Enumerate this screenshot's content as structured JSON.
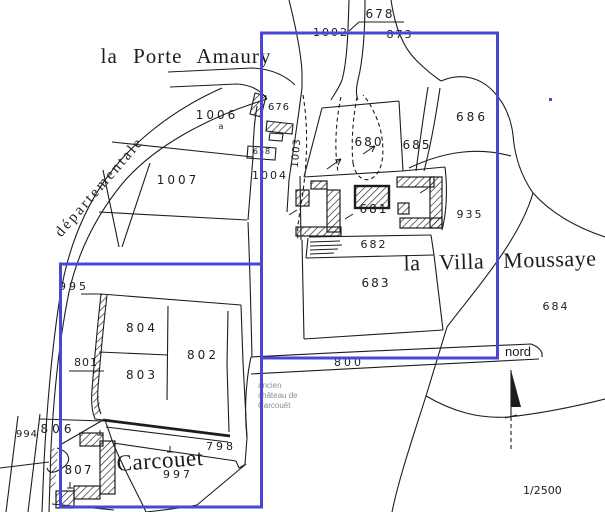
{
  "map": {
    "background": "#ffffff",
    "ink_color": "#1d1d1d",
    "highlight_color": "#4a46d6",
    "note_color": "#8d8d8d",
    "scale_label": "1/2500",
    "north_label": "nord",
    "annotation": {
      "l1": "ancien",
      "l2": "château de",
      "l3": "Carcouët"
    },
    "place_labels": [
      {
        "id": "porte-amaury",
        "text": "la Porte Amaury",
        "x": 186,
        "y": 46,
        "size": 21,
        "rot": 0,
        "ws": 9,
        "ls": 1
      },
      {
        "id": "villa-moussaye",
        "text": "la Villa Moussaye",
        "x": 500,
        "y": 250,
        "size": 22,
        "rot": -1.5,
        "ws": 13,
        "ls": 0.5
      },
      {
        "id": "carcouet",
        "text": "Carcouet",
        "x": 160,
        "y": 449,
        "size": 23,
        "rot": -4,
        "ws": 0,
        "ls": 0.5
      },
      {
        "id": "departementale",
        "text": "départementale",
        "x": 100,
        "y": 180,
        "size": 15,
        "rot": -49,
        "ws": 0,
        "ls": 2.5
      }
    ],
    "parcel_labels": [
      {
        "id": "678",
        "text": "678",
        "x": 380,
        "y": 8,
        "size": 12,
        "ls": 2,
        "rot": 0
      },
      {
        "id": "1002",
        "text": "1002",
        "x": 331,
        "y": 27,
        "size": 11,
        "ls": 2,
        "rot": 0
      },
      {
        "id": "873",
        "text": "873",
        "x": 400,
        "y": 29,
        "size": 11,
        "ls": 2,
        "rot": 0
      },
      {
        "id": "1006",
        "text": "1006",
        "x": 217,
        "y": 109,
        "size": 12,
        "ls": 3,
        "rot": 0
      },
      {
        "id": "1006a",
        "text": "a",
        "x": 221,
        "y": 123,
        "size": 8,
        "ls": 0,
        "rot": 0
      },
      {
        "id": "676",
        "text": "676",
        "x": 279,
        "y": 103,
        "size": 10,
        "ls": 1,
        "rot": 0
      },
      {
        "id": "1003",
        "text": "1003",
        "x": 297,
        "y": 148,
        "size": 10,
        "ls": 1,
        "rot": -85
      },
      {
        "id": "658",
        "text": "658",
        "x": 262,
        "y": 148,
        "size": 8,
        "ls": 1,
        "rot": 0
      },
      {
        "id": "1007",
        "text": "1007",
        "x": 178,
        "y": 174,
        "size": 12,
        "ls": 3,
        "rot": 0
      },
      {
        "id": "1004",
        "text": "1004",
        "x": 270,
        "y": 170,
        "size": 11,
        "ls": 2,
        "rot": 0
      },
      {
        "id": "680",
        "text": "680",
        "x": 369,
        "y": 136,
        "size": 12,
        "ls": 2,
        "rot": 0
      },
      {
        "id": "685",
        "text": "685",
        "x": 417,
        "y": 139,
        "size": 12,
        "ls": 2,
        "rot": 0
      },
      {
        "id": "686",
        "text": "686",
        "x": 472,
        "y": 111,
        "size": 12,
        "ls": 3,
        "rot": 0
      },
      {
        "id": "681",
        "text": "681",
        "x": 374,
        "y": 203,
        "size": 12,
        "ls": 2,
        "rot": 0
      },
      {
        "id": "682",
        "text": "682",
        "x": 374,
        "y": 239,
        "size": 11,
        "ls": 2,
        "rot": 0
      },
      {
        "id": "683",
        "text": "683",
        "x": 376,
        "y": 277,
        "size": 12,
        "ls": 2,
        "rot": 0
      },
      {
        "id": "935",
        "text": "935",
        "x": 470,
        "y": 209,
        "size": 11,
        "ls": 2,
        "rot": 0
      },
      {
        "id": "684",
        "text": "684",
        "x": 556,
        "y": 301,
        "size": 11,
        "ls": 2,
        "rot": 0
      },
      {
        "id": "800",
        "text": "800",
        "x": 349,
        "y": 357,
        "size": 11,
        "ls": 3,
        "rot": 0
      },
      {
        "id": "995",
        "text": "995",
        "x": 74,
        "y": 281,
        "size": 11,
        "ls": 3,
        "rot": 0
      },
      {
        "id": "804",
        "text": "804",
        "x": 142,
        "y": 322,
        "size": 12,
        "ls": 3,
        "rot": 0
      },
      {
        "id": "802",
        "text": "802",
        "x": 203,
        "y": 349,
        "size": 12,
        "ls": 3,
        "rot": 0
      },
      {
        "id": "803",
        "text": "803",
        "x": 142,
        "y": 369,
        "size": 12,
        "ls": 3,
        "rot": 0
      },
      {
        "id": "801",
        "text": "801",
        "x": 86,
        "y": 357,
        "size": 11,
        "ls": 1,
        "rot": 0
      },
      {
        "id": "806",
        "text": "806",
        "x": 58,
        "y": 423,
        "size": 12,
        "ls": 4,
        "rot": 0
      },
      {
        "id": "994",
        "text": "994",
        "x": 27,
        "y": 430,
        "size": 10,
        "ls": 1,
        "rot": 0
      },
      {
        "id": "807",
        "text": "807",
        "x": 79,
        "y": 464,
        "size": 12,
        "ls": 2,
        "rot": 0
      },
      {
        "id": "997",
        "text": "997",
        "x": 178,
        "y": 469,
        "size": 11,
        "ls": 3,
        "rot": 0
      },
      {
        "id": "798",
        "text": "798",
        "x": 221,
        "y": 441,
        "size": 11,
        "ls": 3,
        "rot": 0
      }
    ]
  }
}
